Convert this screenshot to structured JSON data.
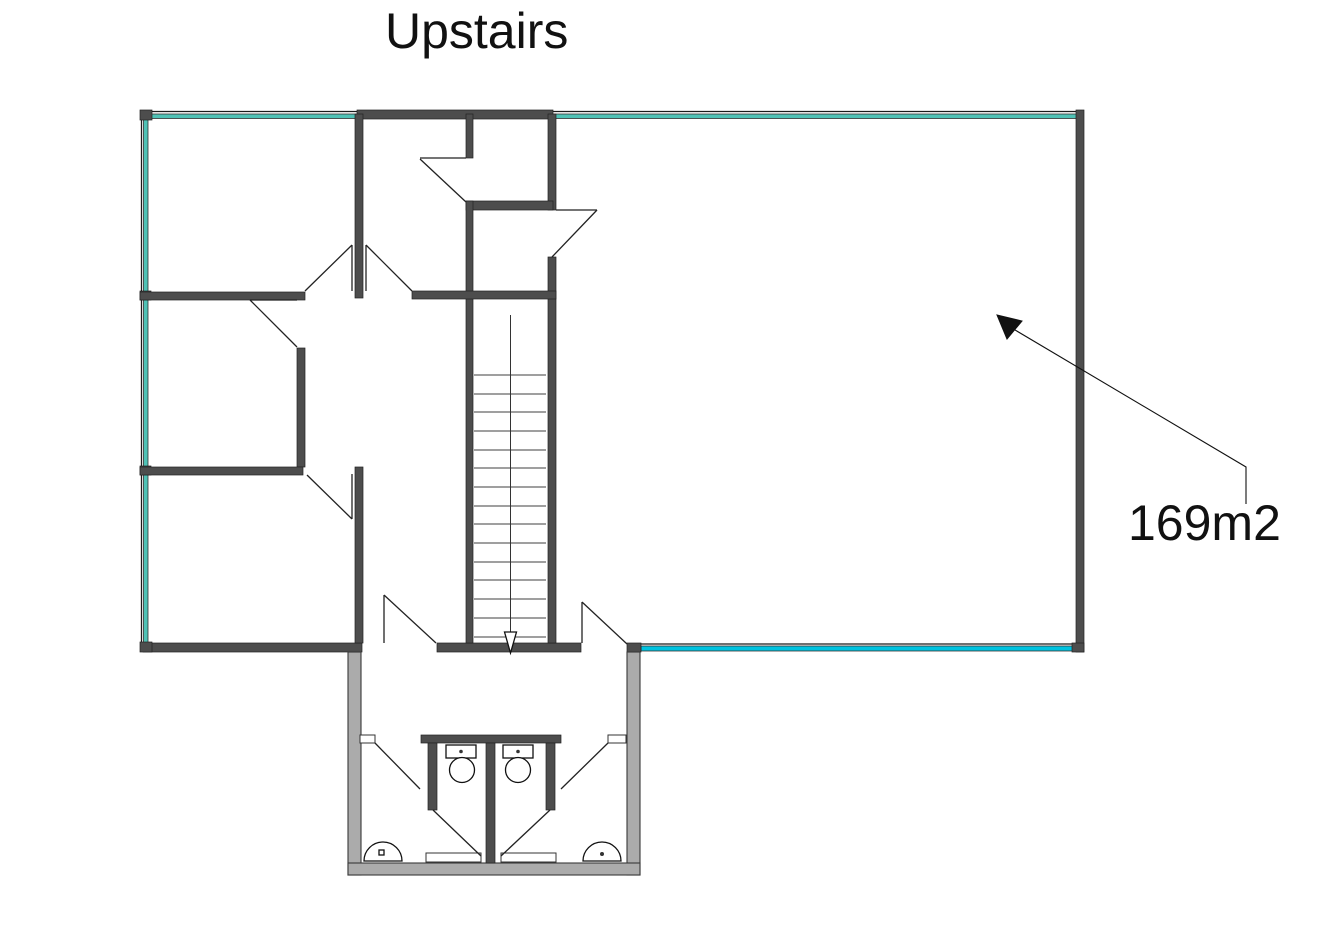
{
  "title": "Upstairs",
  "area_label": "169m2",
  "colors": {
    "wall_dark": "#4d4d4d",
    "wall_outline": "#222222",
    "wall_gray": "#ababab",
    "window_teal": "#4fc1b5",
    "window_cyan": "#00c3e0",
    "line": "#1a1a1a",
    "background": "#ffffff",
    "text": "#111111"
  }
}
